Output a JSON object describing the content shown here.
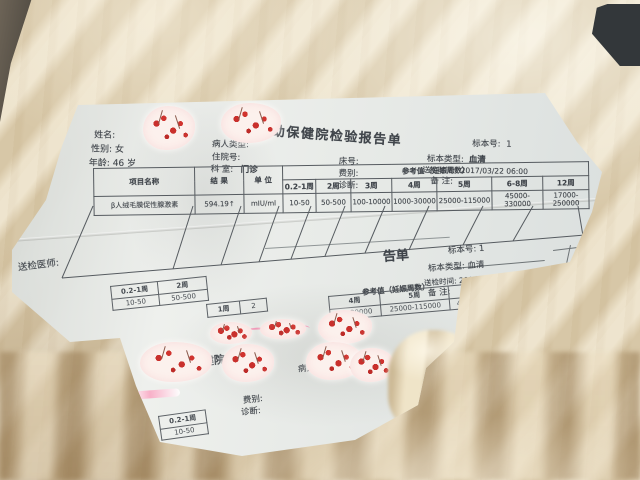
{
  "colors": {
    "blanket": "#e4d7ba",
    "blanket_shadow": "#b3935f",
    "paper": "#e9ebe7",
    "ink": "#40454b",
    "table_line": "#565b60",
    "sticker_base": "#fcf1ed",
    "cherry_red": "#c9302c",
    "pink_mark": "#ef7fa8"
  },
  "report": {
    "title": "妇幼保健院检验报告单",
    "info": {
      "name_label": "姓名:",
      "gender_label": "性别:",
      "gender_value": "女",
      "age_label": "年龄:",
      "age_value": "46 岁",
      "patient_type_label": "病人类型:",
      "admission_label": "住院号:",
      "dept_label": "科 室:",
      "dept_value": "门诊",
      "bed_label": "床号:",
      "fee_label": "费别:",
      "diagnosis_label": "诊断:",
      "sample_no_label": "标本号:",
      "sample_no_value": "1",
      "sample_type_label": "标本类型:",
      "sample_type_value": "血清",
      "send_time_label": "送检时间:",
      "send_time_value": "2017/03/22 06:00",
      "remark_label": "备 注:"
    },
    "table": {
      "item_header": "项目名称",
      "result_header": "结 果",
      "unit_header": "单 位",
      "ref_header": "参考值（妊娠周数）",
      "weeks": [
        "0.2-1周",
        "2周",
        "3周",
        "4周",
        "5周",
        "6-8周",
        "12周"
      ],
      "row": {
        "item": "β人绒毛膜促性腺激素",
        "result": "594.19↑",
        "unit": "mIU/ml",
        "refs": [
          "10-50",
          "50-500",
          "100-10000",
          "1000-30000",
          "25000-115000",
          "45000-330000",
          "17000-250000"
        ]
      }
    },
    "inspector_label": "送检医师:"
  },
  "under": {
    "title_frag": "告单",
    "sample_no": "标本号: 1",
    "sample_type": "标本类型: 血清",
    "send_time": "送检时间: 2017/03/22 06:00",
    "remark": "备 注:",
    "ref_header": "参考值（妊娠周数）",
    "weeks_right": [
      "4周",
      "5周",
      "6-8周"
    ],
    "values_right": [
      "00-30000",
      "25000-115000",
      "45000-3300"
    ],
    "sample_no_right": "标本号: 1",
    "serum_right": "血清",
    "serum_stamp": "血清",
    "sample_frag1": "本号: 1",
    "date_frag": "/03/22 06:00",
    "sample_frag2": "本号:",
    "weeks_left": [
      "0.2-1周",
      "2周"
    ],
    "values_left": [
      "10-50",
      "50-500"
    ],
    "extra_week": "1周",
    "extra_val": "2",
    "bottom": {
      "type_frag": "类型:",
      "hospital_frag": "幼保健院",
      "patient_type": "病人类型:",
      "title_end": "单",
      "fee_label": "费别:",
      "diagnosis_label": "诊断:",
      "week_frag": "0.2-1周",
      "value_frag": "10-50"
    }
  }
}
